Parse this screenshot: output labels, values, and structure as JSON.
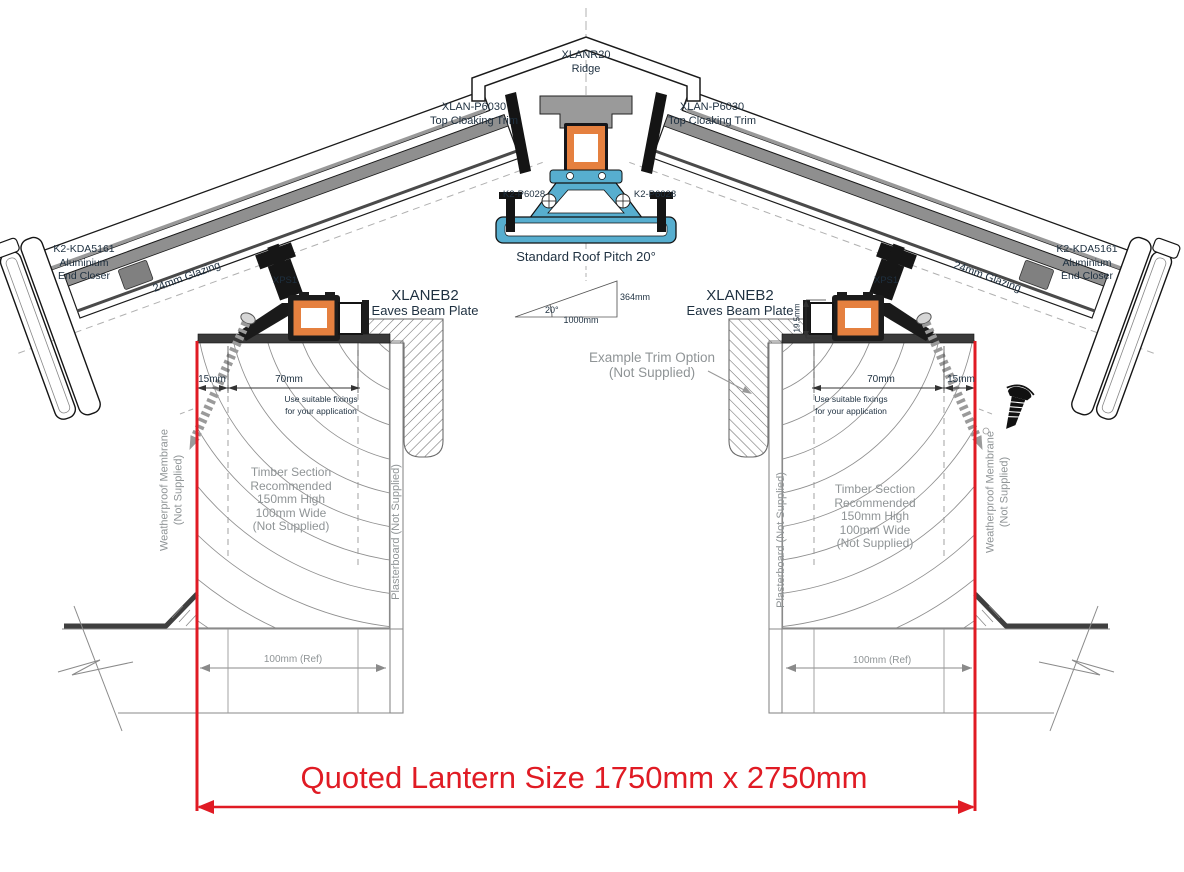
{
  "drawing": {
    "ridge": {
      "code": "XLANR20",
      "name": "Ridge"
    },
    "cloaking": {
      "code": "XLAN-P6030",
      "name": "Top Cloaking Trim"
    },
    "glazing_bar_clip": "K2-P6028",
    "pitch": {
      "title": "Standard Roof Pitch 20°",
      "angle": "20°",
      "run": "1000mm",
      "rise": "364mm"
    },
    "end_closer": {
      "code": "K2-KDA5161",
      "line1": "Aluminium",
      "line2": "End Closer"
    },
    "glazing": "24mm Glazing",
    "xps": "XPS1",
    "eaves_beam": {
      "code": "XLANEB2",
      "name": "Eaves Beam Plate"
    },
    "dims": {
      "edge": "15mm",
      "fixing_zone": "70mm",
      "beam_height": "19.5mm",
      "kerb_ref": "100mm (Ref)"
    },
    "fixings_note": {
      "line1": "Use suitable fixings",
      "line2": "for your application"
    },
    "trim_option": {
      "line1": "Example  Trim Option",
      "line2": "(Not Supplied)"
    },
    "timber_note": {
      "line1": "Timber Section",
      "line2": "Recommended",
      "line3": "150mm High",
      "line4": "100mm Wide",
      "line5": "(Not Supplied)"
    },
    "membrane": {
      "line1": "Weatherproof Membrane",
      "line2": "(Not Supplied)"
    },
    "plasterboard": "Plasterboard (Not Supplied)",
    "quoted_size": "Quoted Lantern Size 1750mm x 2750mm"
  },
  "colors": {
    "accent_red": "#e01b24",
    "profile_orange": "#e5803f",
    "profile_blue": "#57aecf",
    "metal_gray": "#8f8f8f",
    "text_navy": "#1e3040",
    "note_gray": "#8f9496"
  }
}
